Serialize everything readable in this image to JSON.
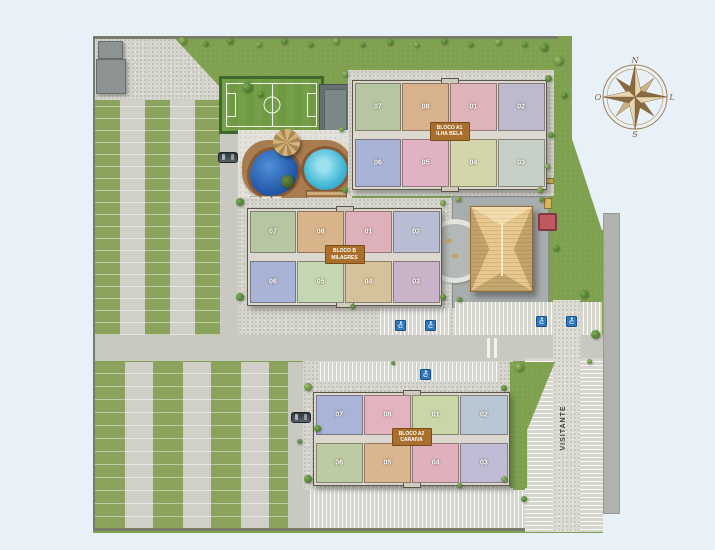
{
  "compass": {
    "north": "N",
    "east": "L",
    "south": "S",
    "west": "O"
  },
  "roads": {
    "visitor_label": "VISITANTE"
  },
  "buildings": [
    {
      "name": "bloco-a1",
      "label": [
        "BLOCO A1",
        "ILHA BELA"
      ],
      "units_top": [
        {
          "n": "07",
          "c": "#b6c6a2"
        },
        {
          "n": "08",
          "c": "#d7b28c"
        },
        {
          "n": "01",
          "c": "#dfb3ba"
        },
        {
          "n": "02",
          "c": "#bdbacd"
        }
      ],
      "units_bottom": [
        {
          "n": "06",
          "c": "#a8b3d6"
        },
        {
          "n": "05",
          "c": "#e0b2c4"
        },
        {
          "n": "04",
          "c": "#d2d6aa"
        },
        {
          "n": "03",
          "c": "#c6d0c6"
        }
      ]
    },
    {
      "name": "bloco-b",
      "label": [
        "BLOCO B",
        "MILAGRES"
      ],
      "units_top": [
        {
          "n": "07",
          "c": "#b6c6a2"
        },
        {
          "n": "08",
          "c": "#d9b38a"
        },
        {
          "n": "01",
          "c": "#deb0ba"
        },
        {
          "n": "02",
          "c": "#b9bdd3"
        }
      ],
      "units_bottom": [
        {
          "n": "06",
          "c": "#a8b3d6"
        },
        {
          "n": "05",
          "c": "#c5d6b2"
        },
        {
          "n": "04",
          "c": "#d6c29a"
        },
        {
          "n": "03",
          "c": "#c9b3c9"
        }
      ]
    },
    {
      "name": "bloco-a2",
      "label": [
        "BLOCO A2",
        "CARAIVA"
      ],
      "units_top": [
        {
          "n": "07",
          "c": "#a9b4d8"
        },
        {
          "n": "08",
          "c": "#e3b4c0"
        },
        {
          "n": "01",
          "c": "#c9d6a8"
        },
        {
          "n": "02",
          "c": "#b9c6d4"
        }
      ],
      "units_bottom": [
        {
          "n": "06",
          "c": "#bccba4"
        },
        {
          "n": "05",
          "c": "#d9b68e"
        },
        {
          "n": "04",
          "c": "#e0b0bd"
        },
        {
          "n": "03",
          "c": "#c0bcd6"
        }
      ]
    }
  ],
  "colors": {
    "background": "#e9f1f8",
    "lawn": "#7fa04f",
    "stripe_green": "#8ba35c",
    "pavement": "#d6d5ce",
    "road": "#c9c9c2",
    "outer_road": "#b2b2ac",
    "field_green": "#6f9a42",
    "pool_dark": "#1c4fa0",
    "pool_light": "#49bcd8",
    "deck_brown": "#a97c4f",
    "roof_tan": "#e7c98f",
    "label_bg": "#a86f2d",
    "accessible_blue": "#2e79c0"
  }
}
